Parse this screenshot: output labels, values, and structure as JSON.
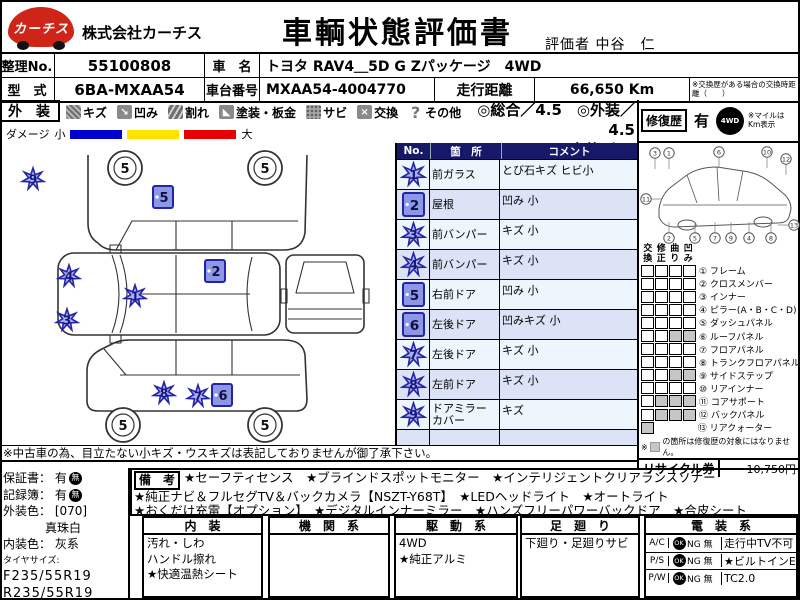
{
  "colors": {
    "logo_red": "#cf2418",
    "marker_stroke": "#2424a8",
    "marker_fill": "#a9b0ef",
    "square_fill": "#8d97e8",
    "bar_blue": "#0000d0",
    "bar_yellow": "#ffe400",
    "bar_red": "#e80000",
    "table_header": "#181868",
    "row_base": "#edf5fd",
    "row_alt": "#dce3f7",
    "gray_cell": "#c6c6c6"
  },
  "header": {
    "logo_text": "カーチス",
    "company": "株式会社カーチス",
    "title": "車輌状態評価書",
    "evaluator_label": "評価者",
    "evaluator_name": "中谷　仁"
  },
  "info": {
    "no_label": "整理No.",
    "no_value": "55100808",
    "car_label": "車　名",
    "car_value": "トヨタ RAV4＿5D G Zパッケージ　4WD",
    "model_label": "型　式",
    "model_value": "6BA-MXAA54",
    "chassis_label": "車台番号",
    "chassis_value": "MXAA54-4004770",
    "mileage_label": "走行距離",
    "mileage_value": "66,650 Km",
    "mileage_note": "※交換歴がある場合の交換時距離（　　）"
  },
  "legend": {
    "section_label": "外　装",
    "items": [
      {
        "icon": "scratch-icon",
        "glyph": "",
        "label": "キズ"
      },
      {
        "icon": "dent-icon",
        "glyph": "↘",
        "label": "凹み"
      },
      {
        "icon": "crack-icon",
        "glyph": "",
        "label": "割れ"
      },
      {
        "icon": "paint-icon",
        "glyph": "◣",
        "label": "塗装・板金"
      },
      {
        "icon": "rust-icon",
        "glyph": "",
        "label": "サビ"
      },
      {
        "icon": "replace-icon",
        "glyph": "×",
        "label": "交換"
      },
      {
        "icon": "other-icon",
        "glyph": "?",
        "label": "その他"
      }
    ],
    "rating_line1": "◎総合／4.5　◎外装／4.5",
    "rating_line2": "◎内装／ Ｂ",
    "repair_label": "修復歴",
    "repair_value": "有",
    "awd_icon_text": "4WD",
    "mile_note": "※マイルは Km表示",
    "damage_label": "ダメージ",
    "damage_small": "小",
    "damage_large": "大"
  },
  "damage_table": {
    "headers": [
      "No.",
      "箇　所",
      "コメント"
    ],
    "rows": [
      {
        "no": "1",
        "type": "scratch",
        "part": "前ガラス",
        "comment": "とび石キズ ヒビ小"
      },
      {
        "no": "2",
        "type": "square",
        "part": "屋根",
        "comment": "凹み 小"
      },
      {
        "no": "3",
        "type": "scratch",
        "part": "前バンパー",
        "comment": "キズ 小"
      },
      {
        "no": "4",
        "type": "scratch",
        "part": "前バンパー",
        "comment": "キズ 小"
      },
      {
        "no": "5",
        "type": "square",
        "part": "右前ドア",
        "comment": "凹み 小"
      },
      {
        "no": "6",
        "type": "square",
        "part": "左後ドア",
        "comment": "凹みキズ 小"
      },
      {
        "no": "7",
        "type": "scratch",
        "part": "左後ドア",
        "comment": "キズ 小"
      },
      {
        "no": "8",
        "type": "scratch",
        "part": "左前ドア",
        "comment": "キズ 小"
      },
      {
        "no": "9",
        "type": "scratch",
        "part": "ドアミラーカバー",
        "comment": "キズ"
      },
      {
        "no": "",
        "type": "none",
        "part": "",
        "comment": ""
      }
    ]
  },
  "diagram": {
    "wheel_label": "5",
    "markers": [
      {
        "num": "9",
        "type": "scratch",
        "x": 33,
        "y": 36
      },
      {
        "num": "5",
        "type": "square",
        "x": 163,
        "y": 54
      },
      {
        "num": "2",
        "type": "square",
        "x": 215,
        "y": 128
      },
      {
        "num": "4",
        "type": "scratch",
        "x": 69,
        "y": 133
      },
      {
        "num": "1",
        "type": "scratch",
        "x": 135,
        "y": 153
      },
      {
        "num": "3",
        "type": "scratch",
        "x": 67,
        "y": 177
      },
      {
        "num": "8",
        "type": "scratch",
        "x": 164,
        "y": 250
      },
      {
        "num": "7",
        "type": "scratch",
        "x": 198,
        "y": 253
      },
      {
        "num": "6",
        "type": "square",
        "x": 222,
        "y": 252
      }
    ],
    "wheels": [
      {
        "x": 125,
        "y": 25
      },
      {
        "x": 265,
        "y": 25
      },
      {
        "x": 123,
        "y": 282
      },
      {
        "x": 265,
        "y": 282
      }
    ]
  },
  "repair_panel": {
    "grid_headers": [
      "交換",
      "修正",
      "曲り",
      "凹み"
    ],
    "wireframe_callouts": [
      {
        "n": "3",
        "x": 16,
        "y": 10,
        "dir": "down"
      },
      {
        "n": "1",
        "x": 30,
        "y": 10,
        "dir": "down"
      },
      {
        "n": "6",
        "x": 80,
        "y": 9,
        "dir": "down"
      },
      {
        "n": "10",
        "x": 128,
        "y": 9,
        "dir": "down"
      },
      {
        "n": "12",
        "x": 147,
        "y": 16,
        "dir": "down"
      },
      {
        "n": "11",
        "x": 7,
        "y": 56,
        "dir": "right"
      },
      {
        "n": "2",
        "x": 30,
        "y": 95,
        "dir": "up"
      },
      {
        "n": "5",
        "x": 56,
        "y": 95,
        "dir": "up"
      },
      {
        "n": "7",
        "x": 76,
        "y": 95,
        "dir": "up"
      },
      {
        "n": "9",
        "x": 92,
        "y": 95,
        "dir": "up"
      },
      {
        "n": "4",
        "x": 110,
        "y": 95,
        "dir": "up"
      },
      {
        "n": "8",
        "x": 132,
        "y": 95,
        "dir": "up"
      },
      {
        "n": "13",
        "x": 155,
        "y": 82,
        "dir": "left"
      }
    ],
    "parts": [
      {
        "num": "①",
        "name": "フレーム",
        "marks": [
          false,
          false,
          false,
          false
        ]
      },
      {
        "num": "②",
        "name": "クロスメンバー",
        "marks": [
          false,
          false,
          false,
          false
        ]
      },
      {
        "num": "③",
        "name": "インナー",
        "marks": [
          false,
          false,
          false,
          false
        ]
      },
      {
        "num": "④",
        "name": "ピラー(A・B・C・D)",
        "marks": [
          false,
          false,
          false,
          false
        ]
      },
      {
        "num": "⑤",
        "name": "ダッシュパネル",
        "marks": [
          false,
          false,
          false,
          false
        ]
      },
      {
        "num": "⑥",
        "name": "ルーフパネル",
        "marks": [
          false,
          false,
          true,
          true
        ]
      },
      {
        "num": "⑦",
        "name": "フロアパネル",
        "marks": [
          false,
          false,
          false,
          false
        ]
      },
      {
        "num": "⑧",
        "name": "トランクフロアパネル",
        "marks": [
          false,
          false,
          false,
          false
        ]
      },
      {
        "num": "⑨",
        "name": "サイドステップ",
        "marks": [
          false,
          false,
          true,
          true
        ]
      },
      {
        "num": "⑩",
        "name": "リアインナー",
        "marks": [
          false,
          false,
          false,
          false
        ]
      },
      {
        "num": "⑪",
        "name": "コアサポート",
        "marks": [
          false,
          true,
          true,
          true
        ]
      },
      {
        "num": "⑫",
        "name": "バックパネル",
        "marks": [
          false,
          true,
          true,
          true
        ]
      },
      {
        "num": "⑬",
        "name": "リアクォーター",
        "marks": [
          true
        ]
      }
    ],
    "note_prefix": "※",
    "note_text": "の箇所は修復歴の対象にはなりません。",
    "recycle_label": "リサイクル券",
    "recycle_value": "10,750円"
  },
  "notes": {
    "used_car": "※中古車の為、目立たない小キズ・ウスキズは表記しておりませんが御了承下さい。"
  },
  "left_info": {
    "warranty_label": "保証書： 有",
    "record_label": "記録簿： 有",
    "badge_text": "無",
    "ext_color_label": "外装色：",
    "ext_color_code": "[070]",
    "ext_color_name": "真珠白",
    "int_color_label": "内装色：",
    "int_color_value": "灰系",
    "tire_label": "タイヤサイズ:",
    "tire_front": "F235/55R19",
    "tire_rear": "R235/55R19"
  },
  "remarks": {
    "label": "備　考",
    "line1": "★セーフティセンス　★ブラインドスポットモニター　★インテリジェントクリアランスソナー",
    "line2": "★純正ナビ＆フルセグTV＆バックカメラ【NSZT-Y68T】　★LEDヘッドライト　★オートライト",
    "line3": "★おくだけ充電【オプション】　★デジタルインナーミラー　★ハンズフリーパワーバックドア　★合皮シート"
  },
  "bottom": {
    "interior": {
      "title": "内　装",
      "lines": [
        "汚れ・しわ",
        "ハンドル擦れ",
        "★快適温熱シート"
      ]
    },
    "engine": {
      "title": "機　関　系",
      "lines": []
    },
    "drive": {
      "title": "駆　動　系",
      "lines": [
        "4WD",
        "★純正アルミ"
      ]
    },
    "suspension": {
      "title": "足　廻　り",
      "lines": [
        "下廻り・足廻りサビ"
      ]
    },
    "electrical": {
      "title": "電　装　系",
      "rows": [
        {
          "name": "A/C",
          "badge": "OK",
          "ng": "NG 無",
          "right": "走行中TV不可"
        },
        {
          "name": "P/S",
          "badge": "OK",
          "ng": "NG 無",
          "right": "★ビルトインE"
        },
        {
          "name": "P/W",
          "badge": "OK",
          "ng": "NG 無",
          "right": "TC2.0"
        }
      ]
    }
  }
}
